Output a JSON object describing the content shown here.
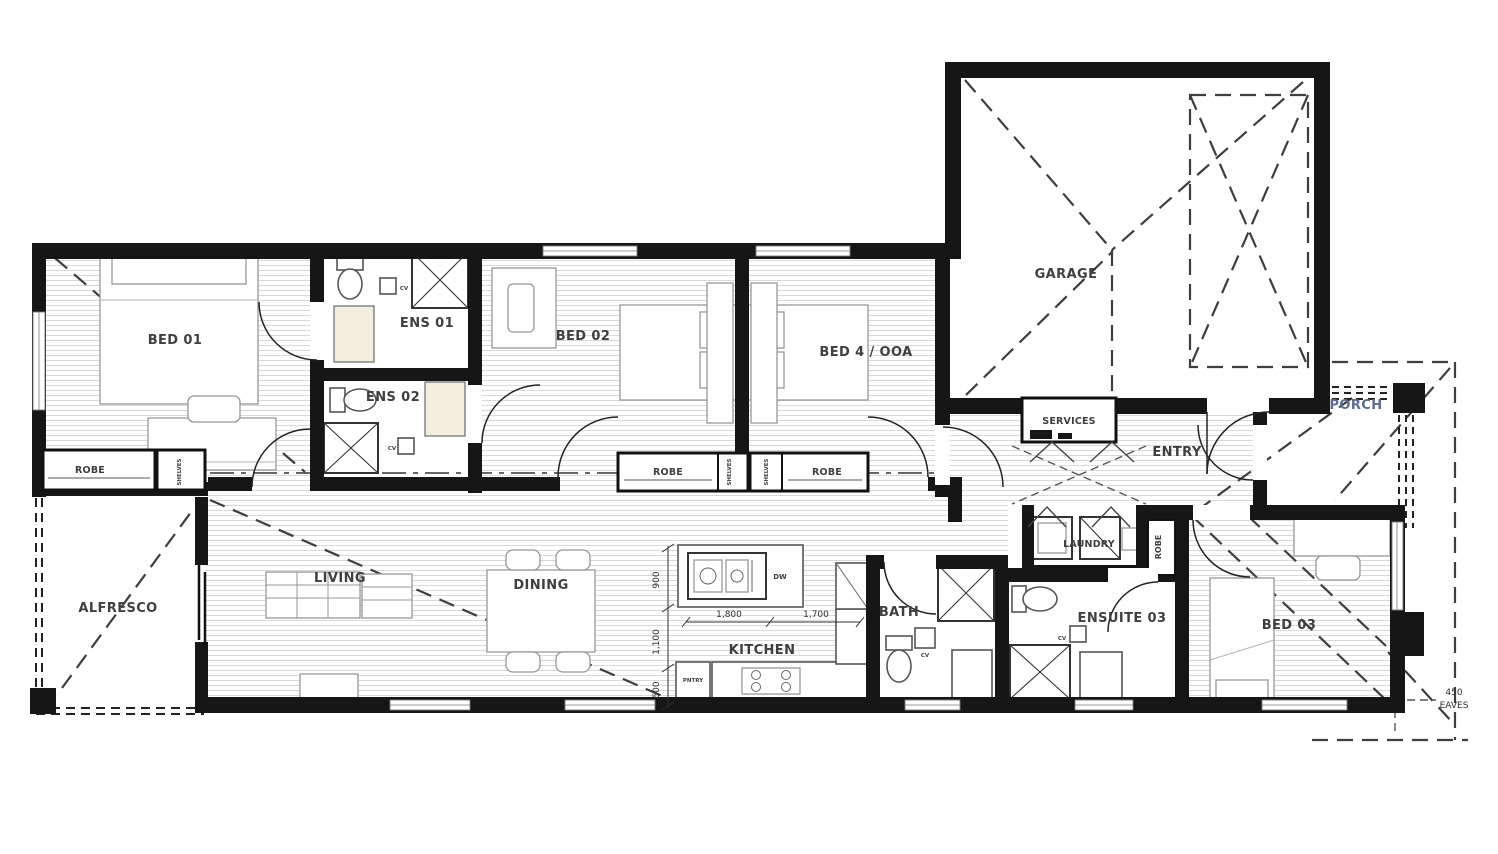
{
  "plan": {
    "rooms": {
      "bed01": "BED 01",
      "ens01": "ENS 01",
      "ens02": "ENS 02",
      "bed02": "BED 02",
      "bed4": "BED 4 / OOA",
      "garage": "GARAGE",
      "services": "SERVICES",
      "entry": "ENTRY",
      "porch": "PORCH",
      "alfresco": "ALFRESCO",
      "living": "LIVING",
      "dining": "DINING",
      "kitchen": "KITCHEN",
      "bath": "BATH",
      "laundry": "LAUNDRY",
      "ensuite03": "ENSUITE 03",
      "bed03": "BED 03"
    },
    "storage": {
      "robe": "ROBE",
      "shelves": "SHELVES",
      "pantry": "PNTRY"
    },
    "appliances": {
      "dw": "DW",
      "cv": "CV"
    },
    "dimensions": {
      "d1800": "1,800",
      "d1700": "1,700",
      "d900": "900",
      "d1100": "1,100",
      "d600": "600",
      "eaves_value": "450",
      "eaves_label": "EAVES"
    },
    "colors": {
      "wall": "#161616",
      "hatch": "#d9d9d9",
      "furniture": "#979797",
      "label": "#3f3f3f",
      "porch_label": "#5b6b94",
      "vanity_fill": "#f2eedd"
    }
  }
}
